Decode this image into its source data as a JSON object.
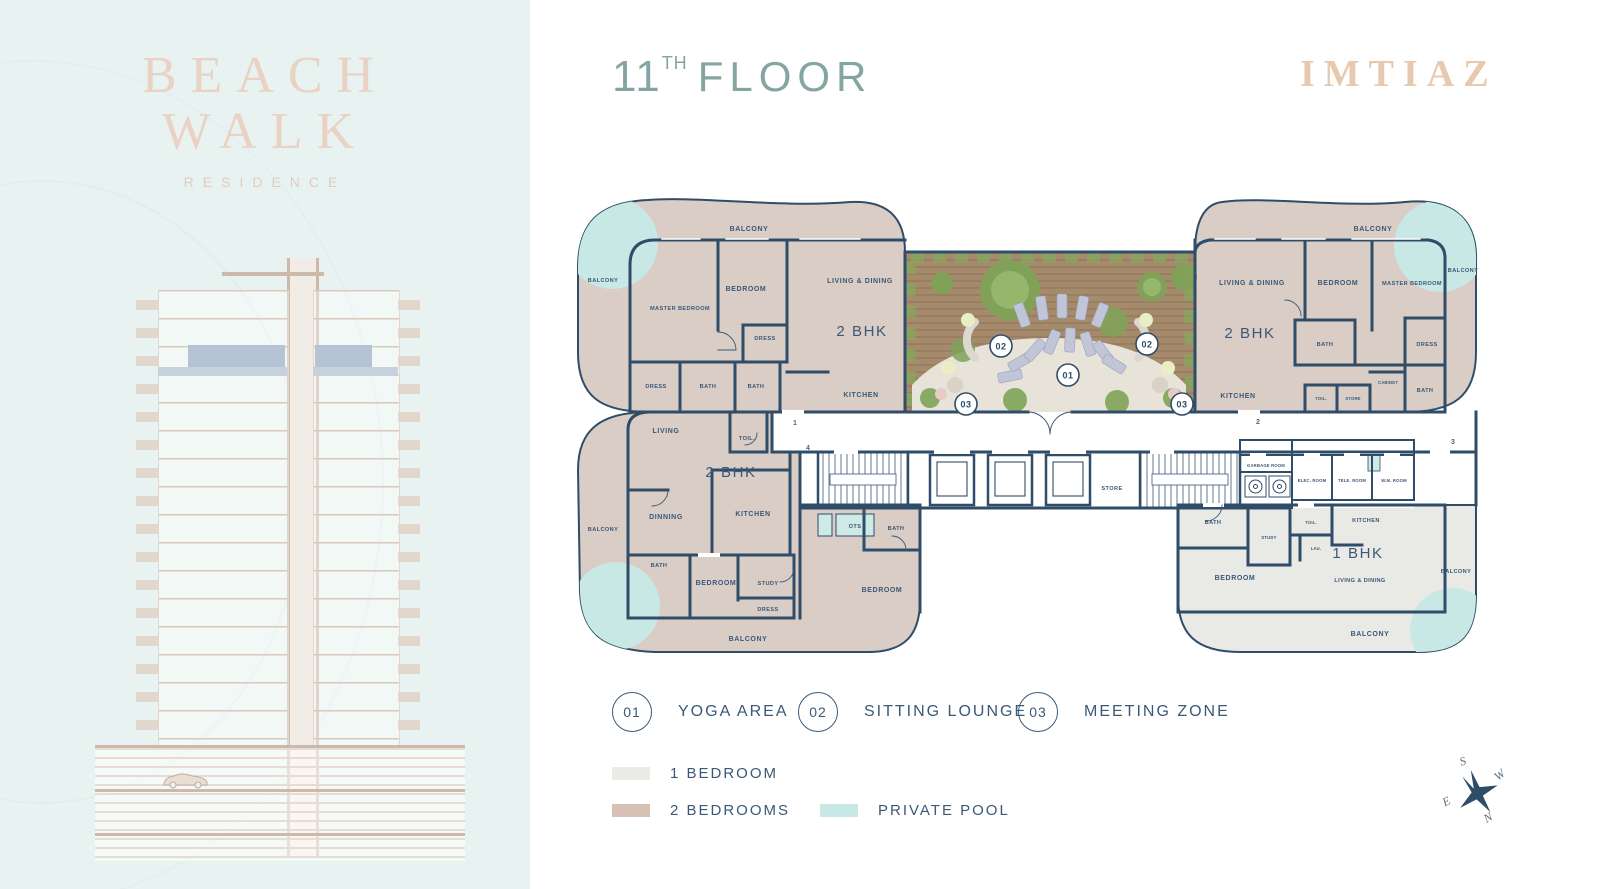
{
  "branding": {
    "logo_line1": "BEACH",
    "logo_line2": "WALK",
    "logo_sub": "RESIDENCE",
    "developer": "IMTIAZ"
  },
  "header": {
    "floor_number": "11",
    "floor_sup": "TH",
    "floor_word": "FLOOR"
  },
  "amenities": [
    {
      "num": "01",
      "label": "YOGA AREA"
    },
    {
      "num": "02",
      "label": "SITTING LOUNGE"
    },
    {
      "num": "03",
      "label": "MEETING ZONE"
    }
  ],
  "legend": [
    {
      "label": "1 BEDROOM",
      "color": "#eceae6"
    },
    {
      "label": "2 BEDROOMS",
      "color": "#d6c2b4"
    },
    {
      "label": "PRIVATE POOL",
      "color": "#c8e8e5"
    }
  ],
  "colors": {
    "navy_walls": "#2f4d68",
    "label_text": "#3b5877",
    "two_bhk_fill": "#d9cdc5",
    "one_bhk_fill": "#e9e9e6",
    "pool": "#c8e8e5",
    "left_panel": "#e8f3f1",
    "title_sage": "#85a5a2",
    "brand_tan": "#e6c9ae",
    "floor_highlight": "#b5c3d4"
  },
  "compass": {
    "n": "N",
    "s": "S",
    "e": "E",
    "w": "W"
  },
  "plan": {
    "markers": {
      "m01": "01",
      "m02": "02",
      "m03": "03"
    },
    "corridor_units": {
      "u1": "1",
      "u2": "2",
      "u3": "3",
      "u4": "4"
    },
    "tl": {
      "balcony_top": "BALCONY",
      "balcony_left": "BALCONY",
      "master": "MASTER BEDROOM",
      "bedroom": "BEDROOM",
      "living": "LIVING & DINING",
      "type": "2 BHK",
      "dress1": "DRESS",
      "dress2": "DRESS",
      "bath1": "BATH",
      "bath2": "BATH",
      "kitchen": "KITCHEN"
    },
    "bl": {
      "living": "LIVING",
      "toil": "TOIL.",
      "type": "2 BHK",
      "dinning": "DINNING",
      "kitchen": "KITCHEN",
      "balcony_left": "BALCONY",
      "bath1": "BATH",
      "bedroom1": "BEDROOM",
      "study": "STUDY",
      "dress": "DRESS",
      "balcony_bottom": "BALCONY",
      "ots": "OTS",
      "bath2": "BATH",
      "bedroom2": "BEDROOM"
    },
    "tr": {
      "balcony_top": "BALCONY",
      "balcony_right": "BALCONY",
      "living": "LIVING & DINING",
      "bedroom": "BEDROOM",
      "master": "MASTER BEDROOM",
      "type": "2 BHK",
      "bath1": "BATH",
      "dress": "DRESS",
      "kitchen": "KITCHEN",
      "toil": "TOIL.",
      "store": "STORE",
      "cabinet": "CABINET",
      "bath2": "BATH"
    },
    "br": {
      "type": "1 BHK",
      "bath": "BATH",
      "study": "STUDY",
      "toil": "TOIL.",
      "lau": "LAU.",
      "kitchen": "KITCHEN",
      "bedroom": "BEDROOM",
      "living": "LIVING & DINING",
      "balcony_bottom": "BALCONY",
      "balcony_right": "BALCONY"
    },
    "core": {
      "store": "STORE",
      "garbage": "GARBAGE ROOM",
      "elec": "ELEC. ROOM",
      "tele": "TELE. ROOM",
      "wm": "W.M. ROOM"
    }
  }
}
